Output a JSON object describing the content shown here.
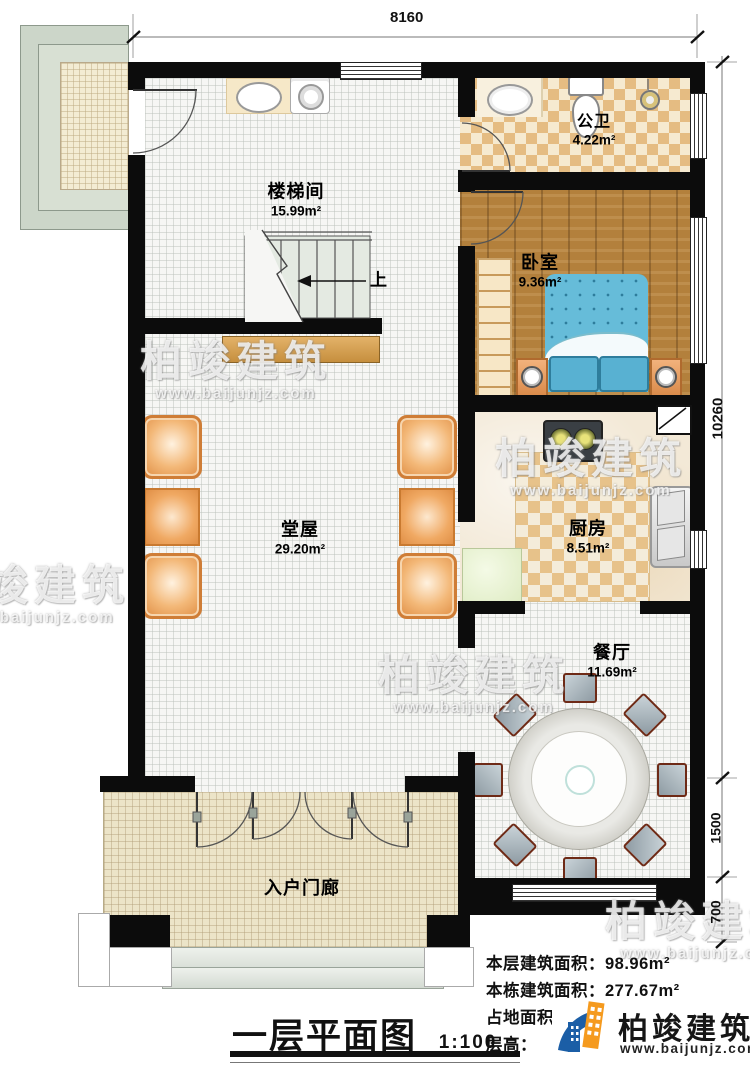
{
  "drawing": {
    "title": "一层平面图",
    "scale": "1:100"
  },
  "dimensions": {
    "top_width": "8160",
    "right_height": "10260",
    "right_dining": "1500",
    "right_porch": "700"
  },
  "rooms": [
    {
      "name": "楼梯间",
      "area": "15.99m²"
    },
    {
      "name": "公卫",
      "area": "4.22m²"
    },
    {
      "name": "卧室",
      "area": "9.36m²"
    },
    {
      "name": "堂屋",
      "area": "29.20m²"
    },
    {
      "name": "厨房",
      "area": "8.51m²"
    },
    {
      "name": "餐厅",
      "area": "11.69m²"
    },
    {
      "name": "入户门廊",
      "area": ""
    }
  ],
  "stairs": {
    "direction_label": "上"
  },
  "info": {
    "floor_area_label": "本层建筑面积：",
    "floor_area_value": "98.96m²",
    "total_area_label": "本栋建筑面积：",
    "total_area_value": "277.67m²",
    "land_area_label": "占地面积：",
    "land_area_value": "104.",
    "height_label": "层高：",
    "height_value": ""
  },
  "branding": {
    "company": "柏竣建筑",
    "website": "www.baijunjz.com"
  },
  "watermark": {
    "company": "柏竣建筑",
    "website": "www.baijunjz.com"
  },
  "colors": {
    "wall": "#0c0c0c",
    "brand_blue": "#1b5ea6",
    "brand_orange": "#f59a1e",
    "wood_floor": "#b3803c",
    "tile_tan": "#e5bc82",
    "bed_blue": "#66bcd9"
  }
}
